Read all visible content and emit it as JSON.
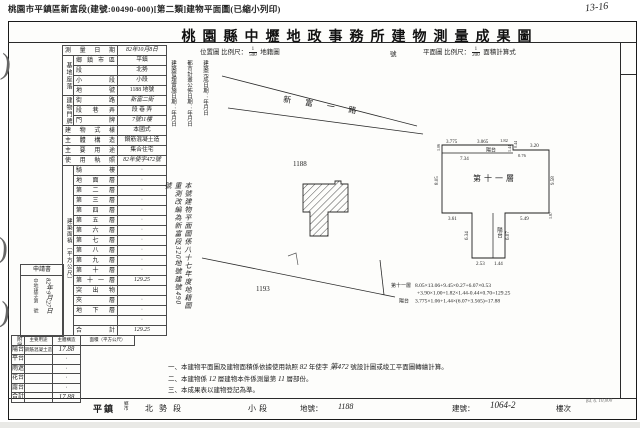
{
  "print_header": "桃園市平鎮區新富段(建號:00490-000)[第二類]建物平面圖(已縮小列印)",
  "title": "桃園縣中壢地政事務所建物測量成果圖",
  "handwriting": {
    "corner_mark": "13-16",
    "margin_marks": [
      ")",
      ")",
      ")"
    ]
  },
  "scale_header": {
    "location_label": "位置圖",
    "scale_label": "比例尺：",
    "location_num": "1",
    "location_den": "500",
    "cadastre_label": "地籍圖",
    "no_label": "號",
    "plan_label": "平面圖",
    "plan_num": "1",
    "plan_den": "200",
    "area_calc_label": "面積計算式"
  },
  "left_form": {
    "survey_date": {
      "label": "測量日期",
      "value": "82年10月8日"
    },
    "site_group": "基地座落",
    "site_rows": [
      {
        "label": "鄉鎮市區",
        "value": "平鎮"
      },
      {
        "label": "段",
        "value": "北勢"
      },
      {
        "label": "小段",
        "value": "小段"
      },
      {
        "label": "地號",
        "value": "1188 地號"
      }
    ],
    "door_group": "建物門牌",
    "door_rows": [
      {
        "label": "街路",
        "value": "新富二街"
      },
      {
        "label": "段巷弄",
        "value": "段 巷 弄"
      },
      {
        "label": "門牌",
        "value": "7號11樓"
      }
    ],
    "style_rows": [
      {
        "label": "建物式樣",
        "value": "本國式"
      },
      {
        "label": "主體構造",
        "value": "鋼筋混凝土造"
      },
      {
        "label": "主要用途",
        "value": "集合住宅"
      },
      {
        "label": "使用執照",
        "value": "82年使字472號",
        "hand": true
      }
    ],
    "area_group_label": "建築面積（平方公尺）",
    "floor_rows": [
      {
        "label": "騎樓",
        "value": "·"
      },
      {
        "label": "地面層",
        "value": "·"
      },
      {
        "label": "第二層",
        "value": "·"
      },
      {
        "label": "第三層",
        "value": "·"
      },
      {
        "label": "第四層",
        "value": "·"
      },
      {
        "label": "第五層",
        "value": "·"
      },
      {
        "label": "第六層",
        "value": "·"
      },
      {
        "label": "第七層",
        "value": "·"
      },
      {
        "label": "第八層",
        "value": "·"
      },
      {
        "label": "第九層",
        "value": "·"
      },
      {
        "label": "第十層",
        "value": "·"
      },
      {
        "label": "第十一層",
        "value": "129.25",
        "hand": true
      },
      {
        "label": "突出物",
        "value": ""
      },
      {
        "label": "夾層",
        "value": "·"
      },
      {
        "label": "地下層",
        "value": "·"
      },
      {
        "label": "",
        "value": "·"
      },
      {
        "label": "合計",
        "value": "129.25",
        "hand": true
      }
    ],
    "annex": {
      "group_label": "附屬建物",
      "headers": [
        "主要用途",
        "主體構造",
        "面積（平方公尺）"
      ],
      "rows": [
        {
          "use": "陽台",
          "structure": "鋼筋混凝土造",
          "area": "17.88",
          "hand": true
        },
        {
          "use": "平台",
          "structure": "",
          "area": "·"
        },
        {
          "use": "雨遮",
          "structure": "",
          "area": "·"
        },
        {
          "use": "花台",
          "structure": "",
          "area": "·"
        },
        {
          "use": "露台",
          "structure": "",
          "area": "·"
        },
        {
          "use": "合計",
          "structure": "",
          "area": "17.88",
          "hand": true
        }
      ]
    },
    "application": {
      "title": "申請書",
      "date": "82年9月27日",
      "doc_no": "中地建字第　號"
    }
  },
  "location_map": {
    "date_columns": [
      "建築管理實施日期：",
      "都市計畫公佈日期：",
      "建築完成日期："
    ],
    "date_units": [
      "年",
      "月",
      "日"
    ],
    "road_label": "新 富 一 路",
    "parcel_1188": "1188",
    "parcel_1193": "1193",
    "renumber_note": "本號建物平面圖係八十七年度地籍圖重測改編為新富段320地號建號490號"
  },
  "floor_plan": {
    "center_label": "第十一層",
    "balcony_top_label": "陽台",
    "balcony_tab_label": "陽台",
    "dims": {
      "top1": "3.775",
      "top1b": "1.06",
      "top2": "3.065",
      "top3": "1.82",
      "balcony_depth": "1.44",
      "step": "0.44",
      "top4": "0.76",
      "top5": "3.20",
      "inner_top": "7.34",
      "left": "8.05",
      "right": "9.58",
      "bottom_left": "3.61",
      "bottom_right": "5.49",
      "right_step": "1.87",
      "tab_left": "6.34",
      "tab_right": "6.07",
      "tab_bottom1": "2.53",
      "tab_bottom2": "1.44"
    },
    "formulas": {
      "line1_label": "第十一層",
      "line1": "8.05×13.06+9.45×0.27+6.07×0.53",
      "line2": "+3.90×1.00+1.82×1.44-0.44×0.70=129.25",
      "line3_label": "陽台",
      "line3": "3.775×1.06+1.44×(6.07+3.565)=17.88"
    }
  },
  "notes": [
    {
      "no": "一、",
      "segments": [
        {
          "t": "本建物平面圖及建物面積係依據使用執照 "
        },
        {
          "t": "82",
          "hand": true
        },
        {
          "t": " 年使字 "
        },
        {
          "t": "第472",
          "hand": true
        },
        {
          "t": " 號設計圖或竣工平面圖轉繪計算。"
        }
      ]
    },
    {
      "no": "二、",
      "segments": [
        {
          "t": "本建物係 "
        },
        {
          "t": "12",
          "hand": true
        },
        {
          "t": " 層建物本件係測量第 "
        },
        {
          "t": "11",
          "hand": true
        },
        {
          "t": " 層部份。"
        }
      ]
    },
    {
      "no": "三、",
      "segments": [
        {
          "t": "本成果表以建物登記為準。"
        }
      ]
    }
  ],
  "bottom_strip": {
    "township": "平鎮",
    "township_units": "鄉市",
    "section": "北勢段",
    "subsection": "小段",
    "parcel_label": "地號：",
    "parcel": "1188",
    "building_label": "建號：",
    "building": "1064-2",
    "floor_label": "樓次",
    "print_info": "84. 6. 10,000"
  }
}
